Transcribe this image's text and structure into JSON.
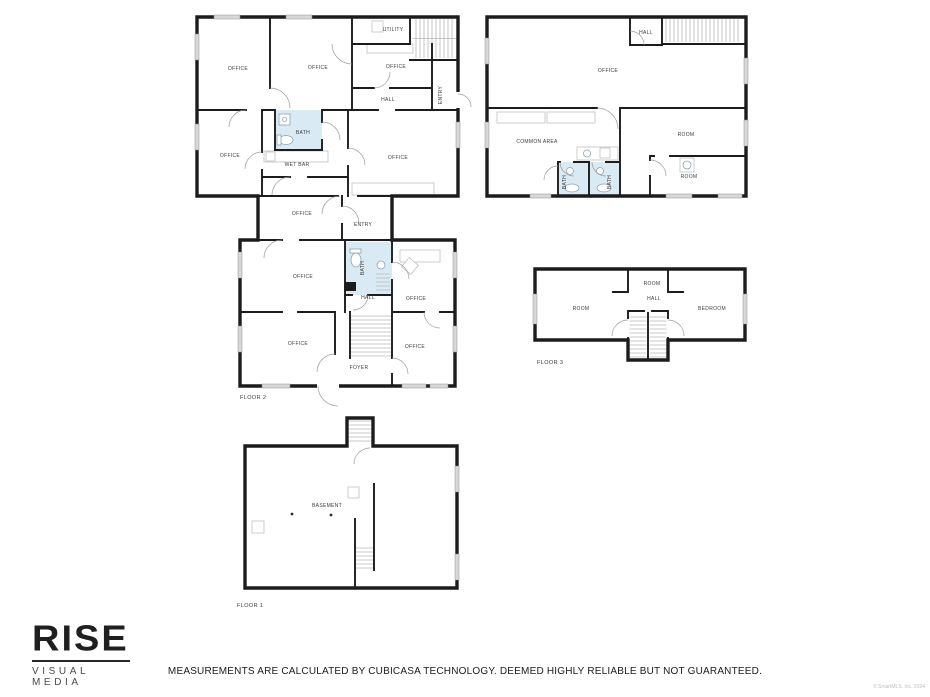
{
  "page": {
    "background": "#ffffff",
    "disclaimer": "MEASUREMENTS ARE CALCULATED BY CUBICASA TECHNOLOGY. DEEMED HIGHLY RELIABLE BUT NOT GUARANTEED.",
    "copyright": "© SmartMLS, Inc. 2024"
  },
  "logo": {
    "brand": "RISE",
    "tagline": "VISUAL MEDIA"
  },
  "colors": {
    "wall": "#1c1c1c",
    "bath_fill": "#daeaf4",
    "door_arc": "#9b9b9b",
    "stair_tread": "#b8b8b8",
    "window": "#d8d8d8",
    "label": "#3c3c3c"
  },
  "floors": [
    {
      "id": "floor-2",
      "label": "FLOOR 2",
      "rooms": [
        {
          "label": "OFFICE"
        },
        {
          "label": "OFFICE"
        },
        {
          "label": "UTILITY"
        },
        {
          "label": "OFFICE"
        },
        {
          "label": "HALL"
        },
        {
          "label": "ENTRY"
        },
        {
          "label": "OFFICE"
        },
        {
          "label": "BATH"
        },
        {
          "label": "WET BAR"
        },
        {
          "label": "OFFICE"
        },
        {
          "label": "OFFICE"
        },
        {
          "label": "ENTRY"
        },
        {
          "label": "OFFICE"
        },
        {
          "label": "BATH"
        },
        {
          "label": "HALL"
        },
        {
          "label": "OFFICE"
        },
        {
          "label": "OFFICE"
        },
        {
          "label": "FOYER"
        },
        {
          "label": "OFFICE"
        }
      ]
    },
    {
      "id": "upper-level",
      "rooms": [
        {
          "label": "HALL"
        },
        {
          "label": "OFFICE"
        },
        {
          "label": "COMMON AREA"
        },
        {
          "label": "BATH"
        },
        {
          "label": "BATH"
        },
        {
          "label": "ROOM"
        },
        {
          "label": "ROOM"
        }
      ]
    },
    {
      "id": "floor-3",
      "label": "FLOOR 3",
      "rooms": [
        {
          "label": "ROOM"
        },
        {
          "label": "ROOM"
        },
        {
          "label": "HALL"
        },
        {
          "label": "BEDROOM"
        }
      ]
    },
    {
      "id": "floor-1",
      "label": "FLOOR 1",
      "rooms": [
        {
          "label": "BASEMENT"
        }
      ]
    }
  ]
}
